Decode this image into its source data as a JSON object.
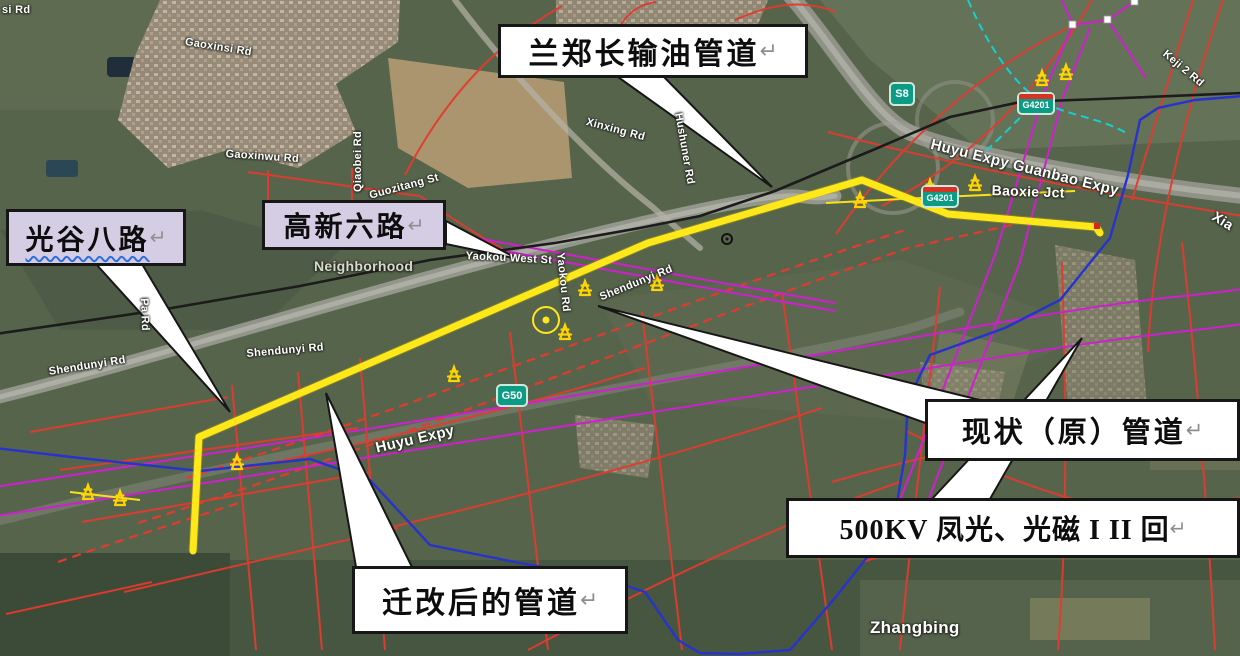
{
  "callouts": {
    "lanzhengchang": {
      "text": "兰郑长输油管道",
      "mark": "↵"
    },
    "guanggu_balu": {
      "text": "光谷八路",
      "mark": "↵"
    },
    "gaoxin_liulu": {
      "text": "高新六路",
      "mark": "↵"
    },
    "xianzhuang": {
      "text": "现状（原）管道",
      "mark": "↵"
    },
    "kv500": {
      "text": "500KV 凤光、光磁 I II 回",
      "mark": "↵"
    },
    "qiangai": {
      "text": "迁改后的管道",
      "mark": "↵"
    }
  },
  "shields": {
    "s8": "S8",
    "g4201_north": "G4201",
    "g4201_south": "G4201",
    "g50": "G50"
  },
  "road_labels": [
    {
      "text": "si Rd"
    },
    {
      "text": "Gaoxinsi Rd"
    },
    {
      "text": "Gaoxinwu Rd"
    },
    {
      "text": "Qiaobei Rd"
    },
    {
      "text": "Guozitang St"
    },
    {
      "text": "Xinxing Rd"
    },
    {
      "text": "Hushuner Rd"
    },
    {
      "text": "Neighborhood"
    },
    {
      "text": "Yaokou West St"
    },
    {
      "text": "Yaokou Rd"
    },
    {
      "text": "Shendunyi Rd"
    },
    {
      "text": "Shendunyi Rd"
    },
    {
      "text": "Shendunyi Rd"
    },
    {
      "text": "Pa Rd"
    },
    {
      "text": "Huyu Expy"
    },
    {
      "text": "Huyu Expy Guanbao Expy"
    },
    {
      "text": "Baoxie Jct"
    },
    {
      "text": "Keji 2 Rd"
    },
    {
      "text": "Xia"
    },
    {
      "text": "Zhangbing"
    }
  ],
  "colors": {
    "relocated_pipeline_yellow": "#FFE81A",
    "lanzhengchang_pipeline_black": "#1C1C1C",
    "pipeline_blue": "#2633CC",
    "powerline_magenta": "#CF1FCF",
    "planned_road_red": "#E23B2E",
    "survey_cyan": "#17CFCF",
    "callout_lavender": "#D4CDE4",
    "pylon_yellow": "#FFD400"
  }
}
